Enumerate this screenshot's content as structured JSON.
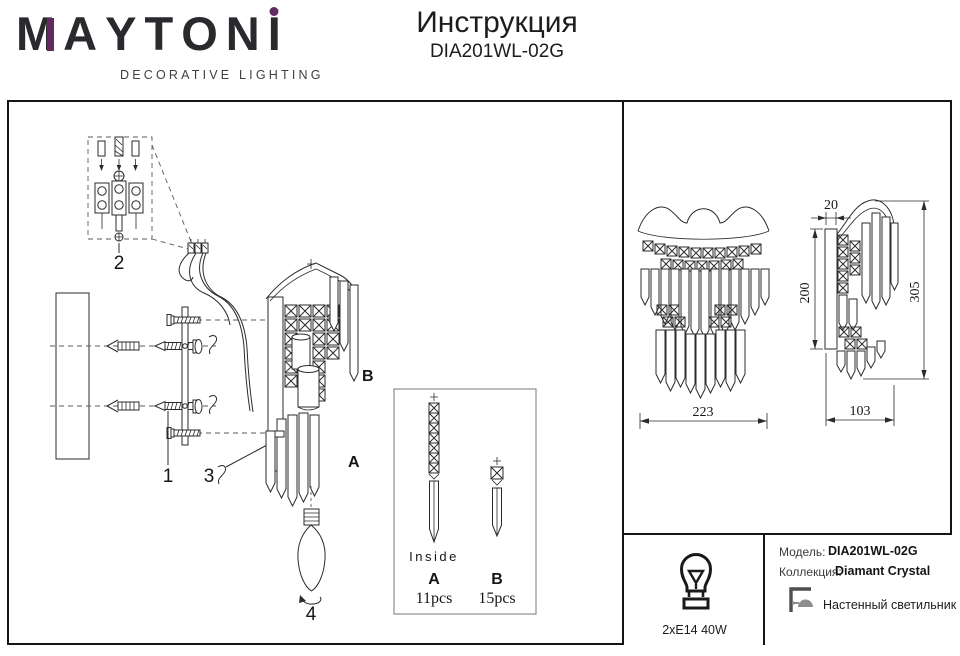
{
  "header": {
    "logo": {
      "letters": [
        "M",
        "A",
        "Y",
        "T",
        "O",
        "N",
        "I"
      ],
      "tagline": "DECORATIVE LIGHTING",
      "accent_color": "#632a60"
    },
    "title": "Инструкция",
    "model": "DIA201WL-02G"
  },
  "diagram": {
    "part_labels": {
      "bracket": "1",
      "terminal": "2",
      "screw": "3",
      "bulb": "4"
    },
    "crystal_a": "A",
    "crystal_b": "B"
  },
  "inside_box": {
    "title": "Inside",
    "item_a_label": "A",
    "item_a_qty": "11pcs",
    "item_b_label": "B",
    "item_b_qty": "15pcs"
  },
  "dimensions": {
    "width": "223",
    "depth": "103",
    "plate_depth": "20",
    "plate_height": "200",
    "total_height": "305"
  },
  "info": {
    "bulb_spec": "2xE14 40W",
    "model_label": "Модель:",
    "model_value": "DIA201WL-02G",
    "collection_label": "Коллекция:",
    "collection_value": "Diamant Crystal",
    "type_text": "Настенный светильник"
  }
}
